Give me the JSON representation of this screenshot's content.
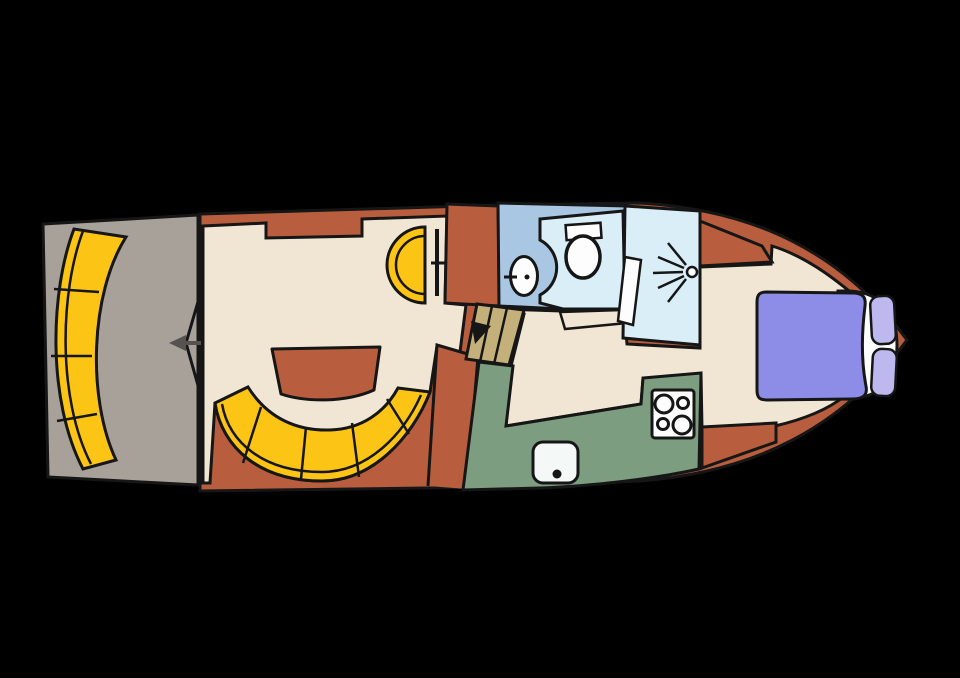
{
  "diagram": {
    "type": "boat-floor-plan",
    "regions": [
      {
        "id": "aft-deck",
        "label": "Aft deck"
      },
      {
        "id": "stern-bench",
        "label": "Curved stern bench"
      },
      {
        "id": "salon",
        "label": "Salon"
      },
      {
        "id": "salon-table",
        "label": "Salon table"
      },
      {
        "id": "salon-sofa",
        "label": "Curved salon sofa"
      },
      {
        "id": "helm",
        "label": "Helm seat and console"
      },
      {
        "id": "companionway",
        "label": "Companionway stairs"
      },
      {
        "id": "bathroom",
        "label": "Bathroom with washbasin and toilet"
      },
      {
        "id": "shower",
        "label": "Shower cabin"
      },
      {
        "id": "galley",
        "label": "Galley with stove and sink"
      },
      {
        "id": "bow-cabin",
        "label": "Bow cabin with double bed"
      }
    ]
  },
  "colors": {
    "background": "#000000",
    "outline": "#161616",
    "hull": "#b85e3e",
    "floor": "#f0e6d3",
    "deck": "#a7a19a",
    "seat": "#fcc414",
    "bath_floor": "#a9c7e2",
    "wet_room": "#daeef7",
    "counter": "#7d9d81",
    "stairs": "#c3b07b",
    "bed": "#8d8ce6",
    "pillow": "#bdb9ee",
    "fixture_white": "#fdfdfd",
    "sink_steel": "#f4f8f6",
    "arrow": "#555250"
  }
}
